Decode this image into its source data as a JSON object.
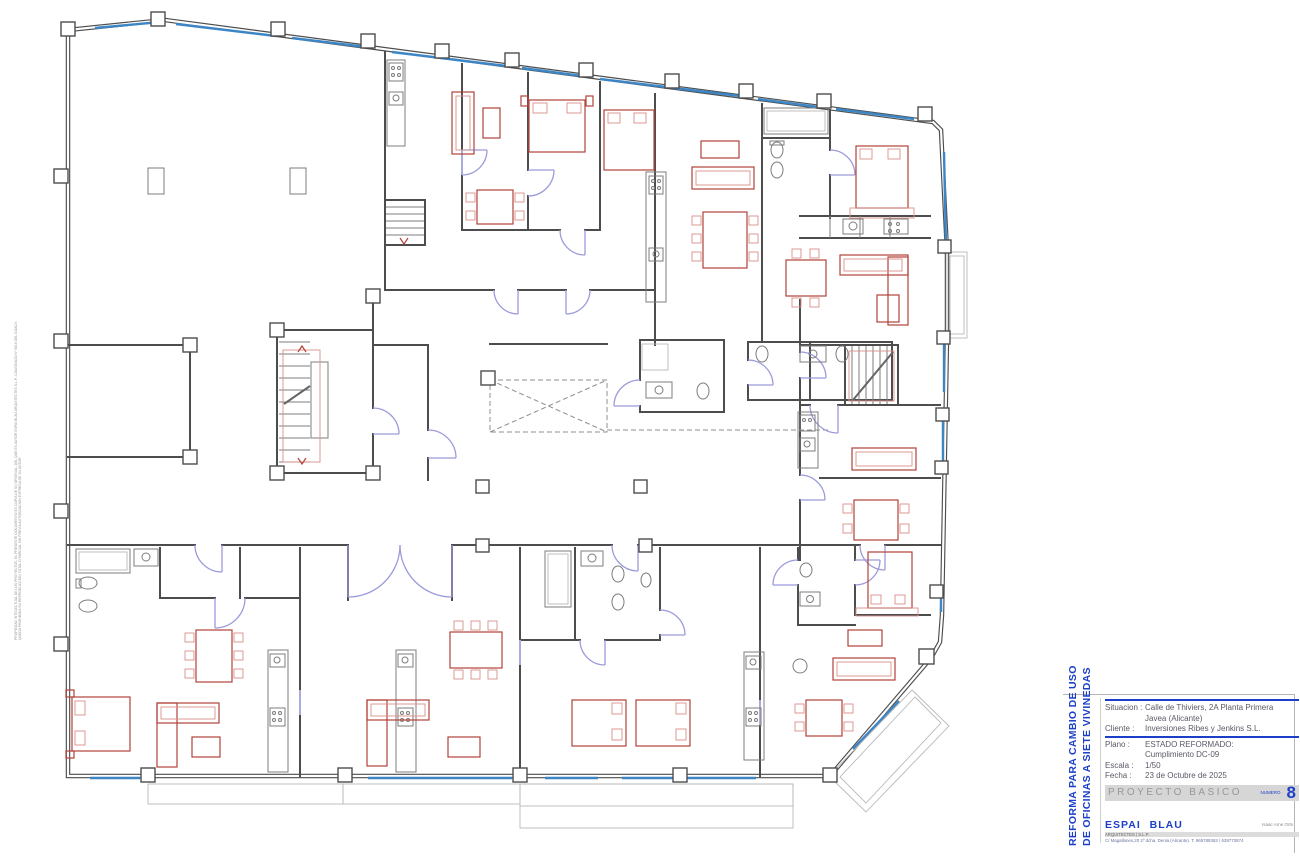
{
  "title_block": {
    "project_title_line1": "REFORMA PARA CAMBIO DE USO",
    "project_title_line2": "DE OFICINAS A SIETE VIVINEDAS",
    "fields": [
      {
        "label": "Situacion :",
        "value": "Calle de Thiviers, 2A Planta Primera",
        "value2": "Javea (Alicante)"
      },
      {
        "label": "Cliente :",
        "value": "Inversiones Ribes y Jenkins S.L.",
        "value2": ""
      },
      {
        "label": "Plano :",
        "value": "ESTADO REFORMADO:",
        "value2": "Cumplimiento DC-09"
      },
      {
        "label": "Escala :",
        "value": "1/50",
        "value2": ""
      },
      {
        "label": "Fecha :",
        "value": "23 de Octubre de 2025",
        "value2": ""
      }
    ],
    "stage_label": "PROYECTO   BASICO",
    "number_label": "NUMERO",
    "number_value": "8",
    "firm_name": "ESPAI  BLAU",
    "firm_subtitle": "ARQUITECTES   |   S.L.P.",
    "firm_address": "C/ Magallanes,20 2º dcha. Denia (Alicante). T. 965789363 / 639770874",
    "architect_name": "Isaac Arne Orts",
    "colors": {
      "accent_blue": "#1b3fc8",
      "bar_gray": "#d6d6d6",
      "wall_gray": "#4d4d4d",
      "furniture_red": "#b2423a",
      "door_purple": "#9b9bdc",
      "glazing_blue": "#3d86c6"
    }
  },
  "side_note": {
    "line1": "PROPIEDAD INTELECTUAL DE LOS PROYECTOS. EL PRESENTE DOCUMENTO ES COPIA DE SU ORIGINAL, DEL QUE ES AUTOR ESPAI BLAU ARQUITECTES S.L.P., COLEGIADO Nº 9816 DEL COACV.",
    "line2": "QUEDA PROHIBIDA SU REPRODUCCION TOTAL O PARCIAL SIN PREVIA AUTORIZACION EXPRESA DE SU AUTOR."
  },
  "drawing": {
    "kind": "architectural-floor-plan",
    "floor": "Planta Primera",
    "scale": "1/50"
  }
}
